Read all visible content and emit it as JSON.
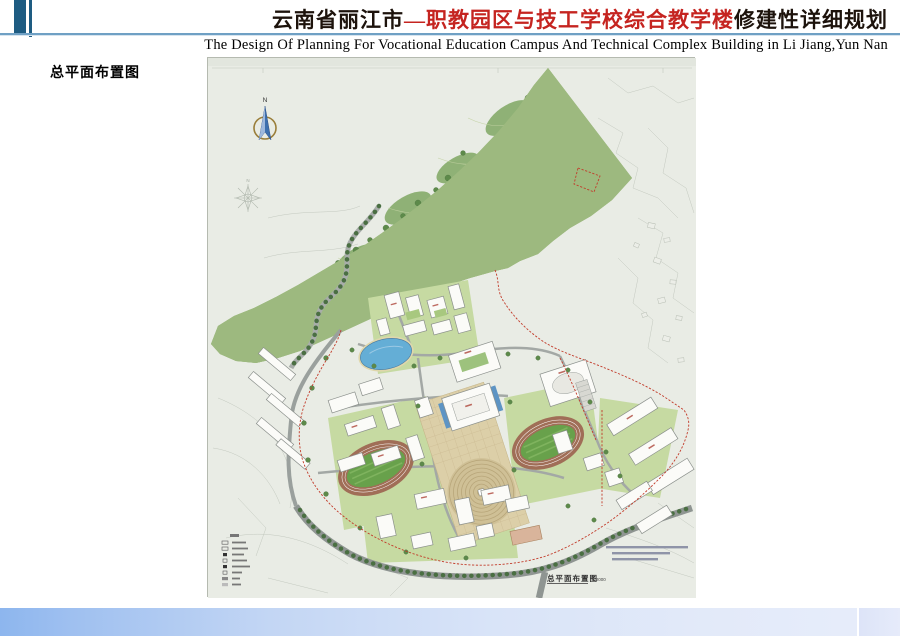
{
  "header": {
    "title_part1": "云南省丽江市",
    "title_part2": "—职教园区与技工学校综合教学楼",
    "title_part3": "修建性详细规划",
    "subtitle": "The Design Of Planning For Vocational Education Campus And Technical Complex Building in Li Jiang,Yun Nan",
    "accent_dark_blue": "#1e5c82",
    "rule_color": "#6fa0c4",
    "title_red": "#c52420",
    "title_dark": "#1d130c"
  },
  "section_label": "总平面布置图",
  "plan": {
    "north_label": "N",
    "caption": "总平面布置图",
    "scale": "1:2000",
    "background": "#e9ece5",
    "boundary_color": "#c23b2a",
    "forest_green": "#9db97f",
    "water_blue": "#64aed6",
    "track_brown": "#a06e57",
    "field_green": "#68a14b"
  },
  "footer": {
    "bar_left_color": "#8db6ee",
    "bar_right_color": "#e6ebfa"
  }
}
